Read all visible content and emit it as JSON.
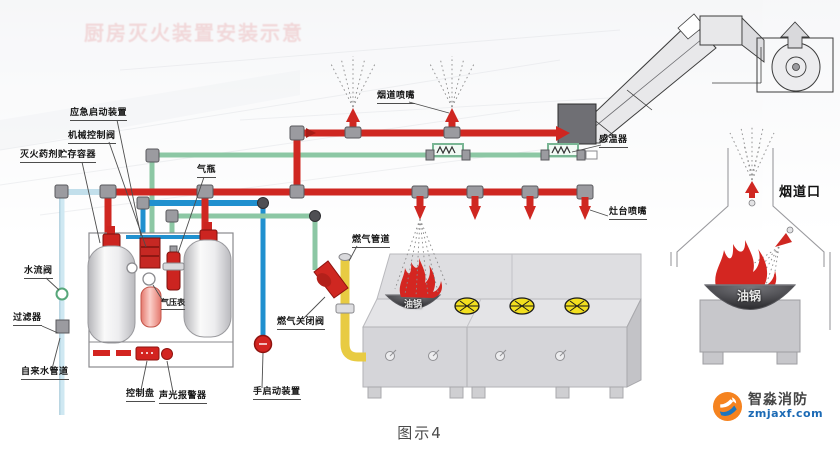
{
  "page": {
    "watermark_title": "厨房灭火装置安装示意",
    "caption": "图示4"
  },
  "labels": {
    "emergency_start": "应急启动装置",
    "mechanical_control_valve": "机械控制阀",
    "agent_storage_container": "灭火药剂贮存容器",
    "gas_cylinder": "气瓶",
    "water_flow_valve": "水流阀",
    "filter": "过滤器",
    "tap_water_pipe": "自来水管道",
    "pressure_gauge": "气压表",
    "control_panel": "控制盘",
    "sound_light_alarm": "声光报警器",
    "manual_start": "手启动装置",
    "gas_shutoff_valve": "燃气关闭阀",
    "gas_pipe": "燃气管道",
    "flue_nozzle": "烟道喷嘴",
    "temp_sensor": "感温器",
    "stove_nozzle": "灶台喷嘴",
    "flue_opening": "烟道口",
    "wok_left": "油锅",
    "wok_right": "油锅"
  },
  "logo": {
    "name": "智淼消防",
    "url": "zmjaxf.com",
    "icon": "fire-swoosh-icon"
  },
  "colors": {
    "pipe_red": "#cf2721",
    "pipe_green": "#8cc7a4",
    "pipe_blue": "#2090cf",
    "pipe_water_pale": "#cfe8f2",
    "pipe_gas_yellow": "#f0d44a",
    "fitting_gray": "#9b9ba0",
    "flame_red": "#d42621",
    "burner_yellow": "#f2df1f",
    "logo_orange": "#f5831f",
    "logo_blue": "#1c75bc"
  }
}
